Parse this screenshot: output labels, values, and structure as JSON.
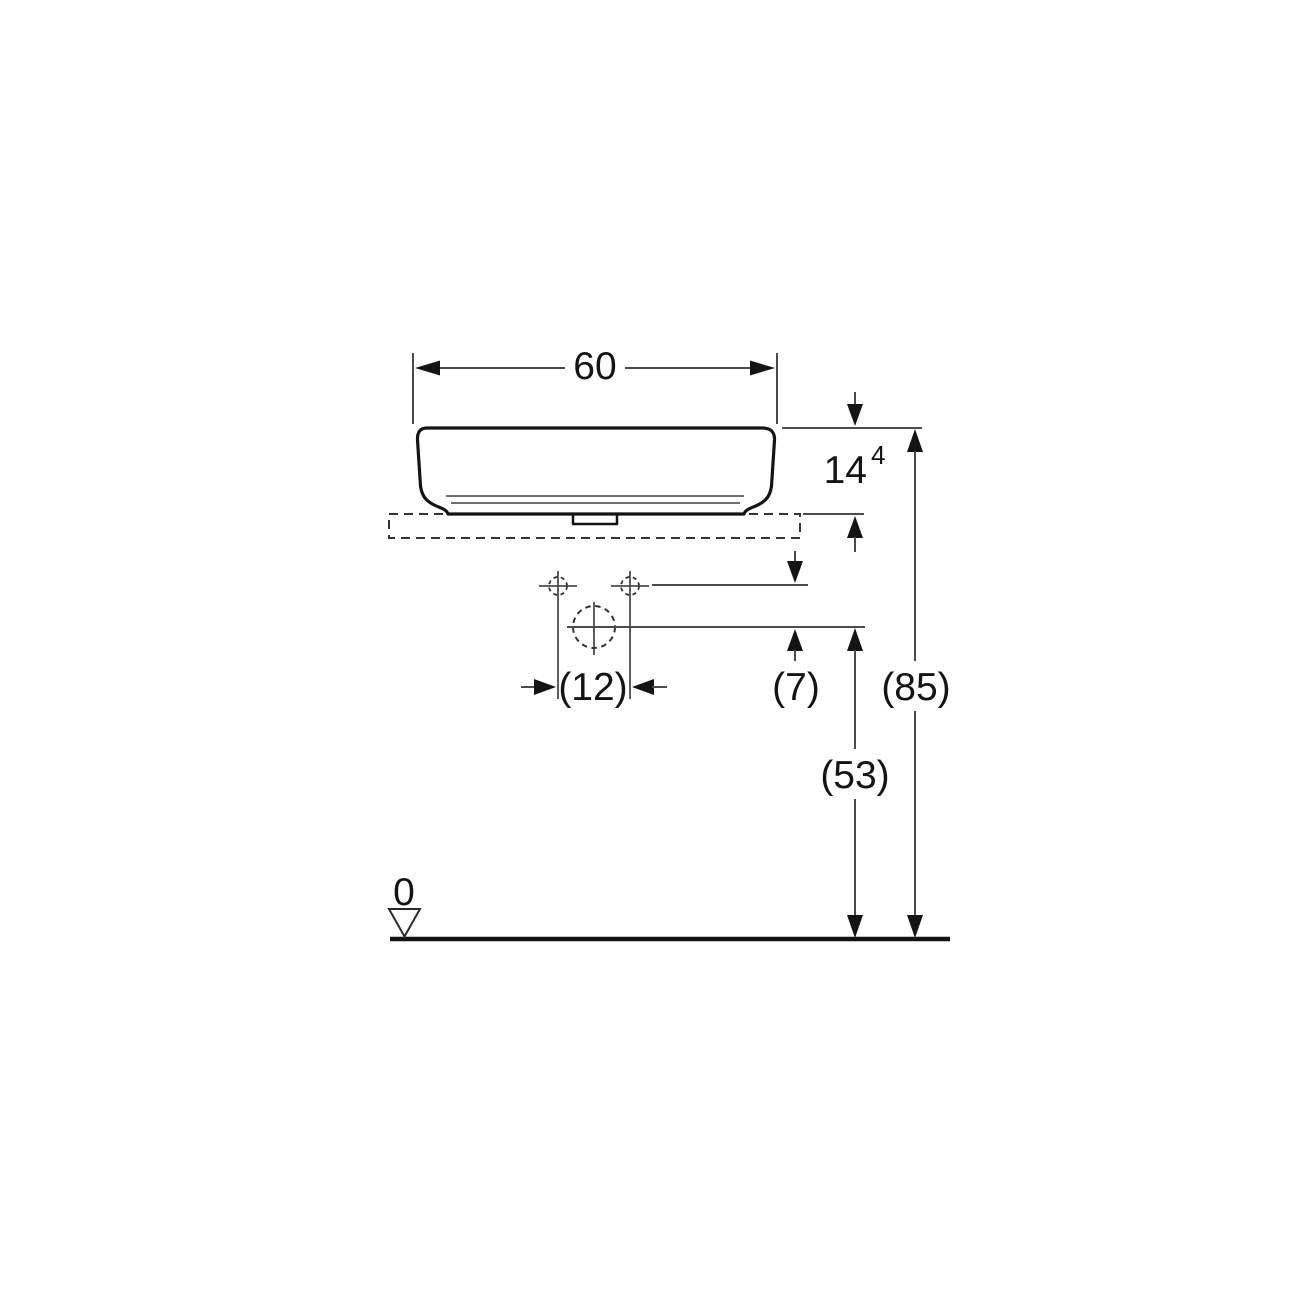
{
  "drawing": {
    "kind": "technical-dimension-drawing",
    "view": "washbasin-front-elevation",
    "colors": {
      "background": "#ffffff",
      "outline": "#141414",
      "dimension_line": "#4b4b4b",
      "dashed_line": "#333333",
      "text": "#141414"
    },
    "dimensions": {
      "basin_width": {
        "text": "60"
      },
      "basin_height": {
        "text": "14",
        "superscript": "4"
      },
      "tap_hole_spacing": {
        "text": "(12)"
      },
      "counter_to_drain": {
        "text": "(7)"
      },
      "rim_height_total": {
        "text": "(85)"
      },
      "drain_center_height": {
        "text": "(53)"
      },
      "floor_datum": {
        "text": "0"
      }
    }
  }
}
